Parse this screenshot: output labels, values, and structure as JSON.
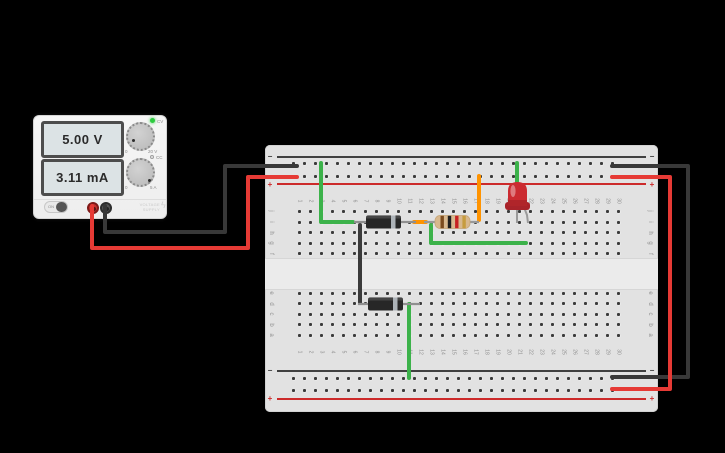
{
  "app": "circuit-simulator-canvas",
  "background_color": "#000000",
  "power_supply": {
    "voltage_display": "5.00 V",
    "current_display": "3.11 mA",
    "cv_indicator_label": "CV",
    "cc_indicator_label": "CC",
    "voltage_knob": {
      "min_label": "0",
      "max_label": "20 V"
    },
    "current_knob": {
      "min_label": "0",
      "max_label": "5 A"
    },
    "on_switch_label": "ON",
    "brand_line1": "VOLTAGE",
    "brand_line2": "SUPPLY",
    "bolt_glyph": "ϟ",
    "terminals": [
      "red-positive",
      "black-negative"
    ]
  },
  "breadboard": {
    "columns": 30,
    "row_letters_top": [
      "j",
      "i",
      "h",
      "g",
      "f"
    ],
    "row_letters_bottom": [
      "e",
      "d",
      "c",
      "b",
      "a"
    ],
    "rail_negative_symbol": "−",
    "rail_positive_symbol": "+"
  },
  "circuit": {
    "components": {
      "diodes": [
        {
          "name": "diode-top",
          "body_color": "black",
          "stripe_color": "gray",
          "stripe_side": "right",
          "location": "top half, row i, columns 7-12",
          "y": 222,
          "lead_x1": 354,
          "lead_x2": 416,
          "body_x1": 366,
          "body_x2": 401,
          "stripe_x": 391
        },
        {
          "name": "diode-bottom",
          "body_color": "black",
          "stripe_color": "gray",
          "stripe_side": "right",
          "location": "bottom half, row d, columns 7-12",
          "y": 304,
          "lead_x1": 358,
          "lead_x2": 420,
          "body_x1": 368,
          "body_x2": 403,
          "stripe_x": 393
        }
      ],
      "resistor": {
        "name": "resistor",
        "bands": [
          "brown",
          "black",
          "red",
          "gold"
        ],
        "band_colors": [
          "#7b4b1e",
          "#1e1e1e",
          "#c62222",
          "#c69c3f"
        ],
        "body_color": "#d8b88e",
        "location": "top half, row i, columns 13-17",
        "y": 222,
        "lead_x1": 424,
        "lead_x2": 479,
        "body_x1": 435,
        "body_x2": 470
      },
      "led": {
        "name": "led",
        "color": "red",
        "location": "top half, columns 20-21",
        "cx": 517.5,
        "dome_top": 182,
        "dome_bottom": 206,
        "flange_y": 202,
        "cathode_x": 517,
        "anode_x": 528,
        "lead_bottom_y": 223
      }
    },
    "wires": [
      {
        "name": "wire-black-psu-to-neg-rail",
        "color": "#383838",
        "points": [
          [
            105,
            206
          ],
          [
            105,
            232
          ],
          [
            225,
            232
          ],
          [
            225,
            166
          ],
          [
            297,
            166
          ]
        ]
      },
      {
        "name": "wire-red-psu-to-pos-rail",
        "color": "#e63a35",
        "points": [
          [
            92,
            206
          ],
          [
            92,
            248
          ],
          [
            248,
            248
          ],
          [
            248,
            177
          ],
          [
            297,
            177
          ]
        ]
      },
      {
        "name": "wire-green-negrail-to-diode-top",
        "color": "#3cb24a",
        "points": [
          [
            321,
            163
          ],
          [
            321,
            222
          ],
          [
            353,
            222
          ]
        ]
      },
      {
        "name": "wire-black-diode-to-diode",
        "color": "#3a3a3a",
        "points": [
          [
            360,
            225
          ],
          [
            360,
            303
          ]
        ]
      },
      {
        "name": "wire-orange-diode-to-resistor",
        "color": "#ff9300",
        "points": [
          [
            414,
            222
          ],
          [
            426,
            222
          ]
        ]
      },
      {
        "name": "wire-orange-posrail-to-resistor",
        "color": "#ff9300",
        "points": [
          [
            479,
            176
          ],
          [
            479,
            220
          ]
        ]
      },
      {
        "name": "wire-green-resistor-to-led-anode",
        "color": "#3cb24a",
        "points": [
          [
            431,
            225
          ],
          [
            431,
            243
          ],
          [
            526,
            243
          ]
        ]
      },
      {
        "name": "wire-green-negrail-to-led-cathode",
        "color": "#3cb24a",
        "points": [
          [
            517,
            163
          ],
          [
            517,
            200
          ]
        ]
      },
      {
        "name": "wire-green-diode-to-bottom-negrail",
        "color": "#3cb24a",
        "points": [
          [
            409,
            304
          ],
          [
            409,
            378
          ]
        ]
      },
      {
        "name": "wire-black-toprail-to-bottomrail",
        "color": "#383838",
        "points": [
          [
            612,
            166
          ],
          [
            688,
            166
          ],
          [
            688,
            377
          ],
          [
            612,
            377
          ]
        ]
      },
      {
        "name": "wire-red-toprail-to-bottomrail",
        "color": "#e63a35",
        "points": [
          [
            612,
            177
          ],
          [
            670,
            177
          ],
          [
            670,
            389
          ],
          [
            612,
            389
          ]
        ]
      }
    ]
  }
}
